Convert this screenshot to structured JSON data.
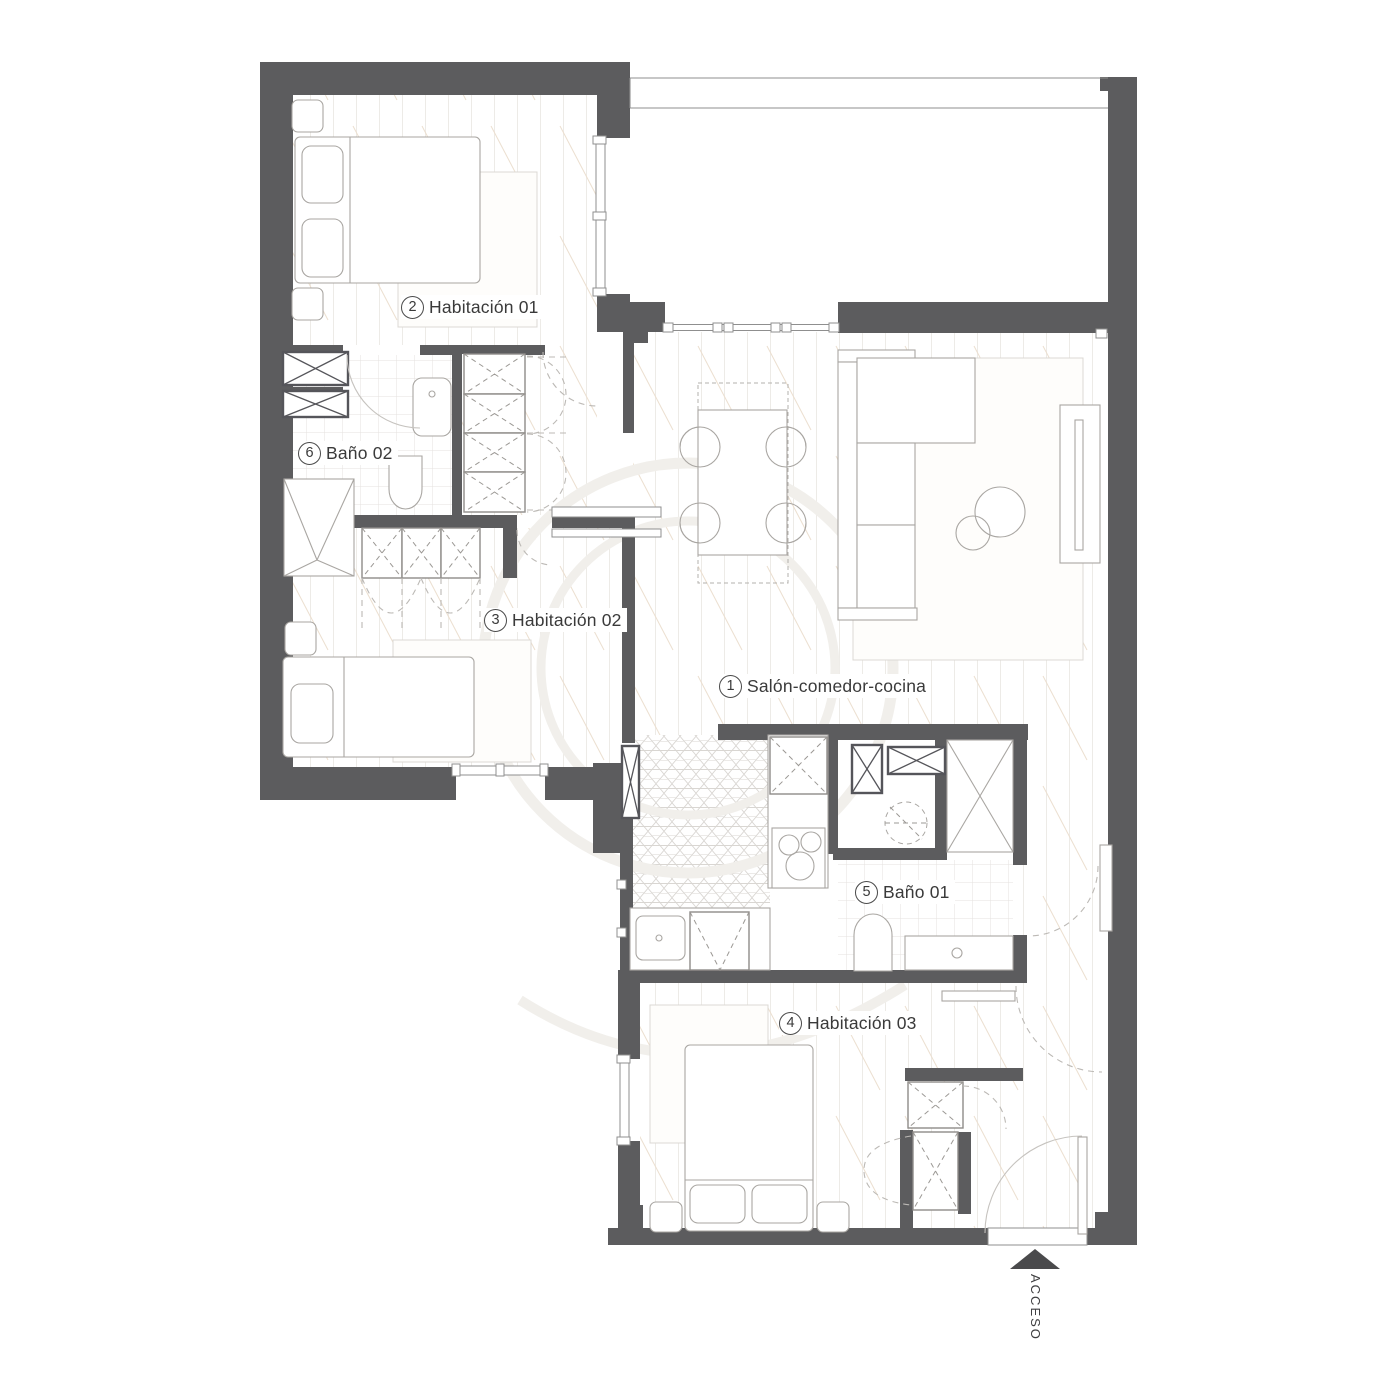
{
  "rooms": [
    {
      "number": "1",
      "label": "Salón-comedor-cocina"
    },
    {
      "number": "2",
      "label": "Habitación 01"
    },
    {
      "number": "3",
      "label": "Habitación 02"
    },
    {
      "number": "4",
      "label": "Habitación 03"
    },
    {
      "number": "5",
      "label": "Baño 01"
    },
    {
      "number": "6",
      "label": "Baño 02"
    }
  ],
  "access": {
    "label": "ACCESO"
  },
  "colors": {
    "wall": "#5c5c5e",
    "fixture_line": "#a9a6a2",
    "plank_line": "#edebe7",
    "hatch_diagonal": "#ecdfd0",
    "tile_line": "#e4e2df",
    "hex_line": "#d9d6d2",
    "door_arc": "#bcb9b5",
    "label_text": "#3a3a3a",
    "access_arrow": "#4a4a4c",
    "watermark": "#f1efeb"
  }
}
